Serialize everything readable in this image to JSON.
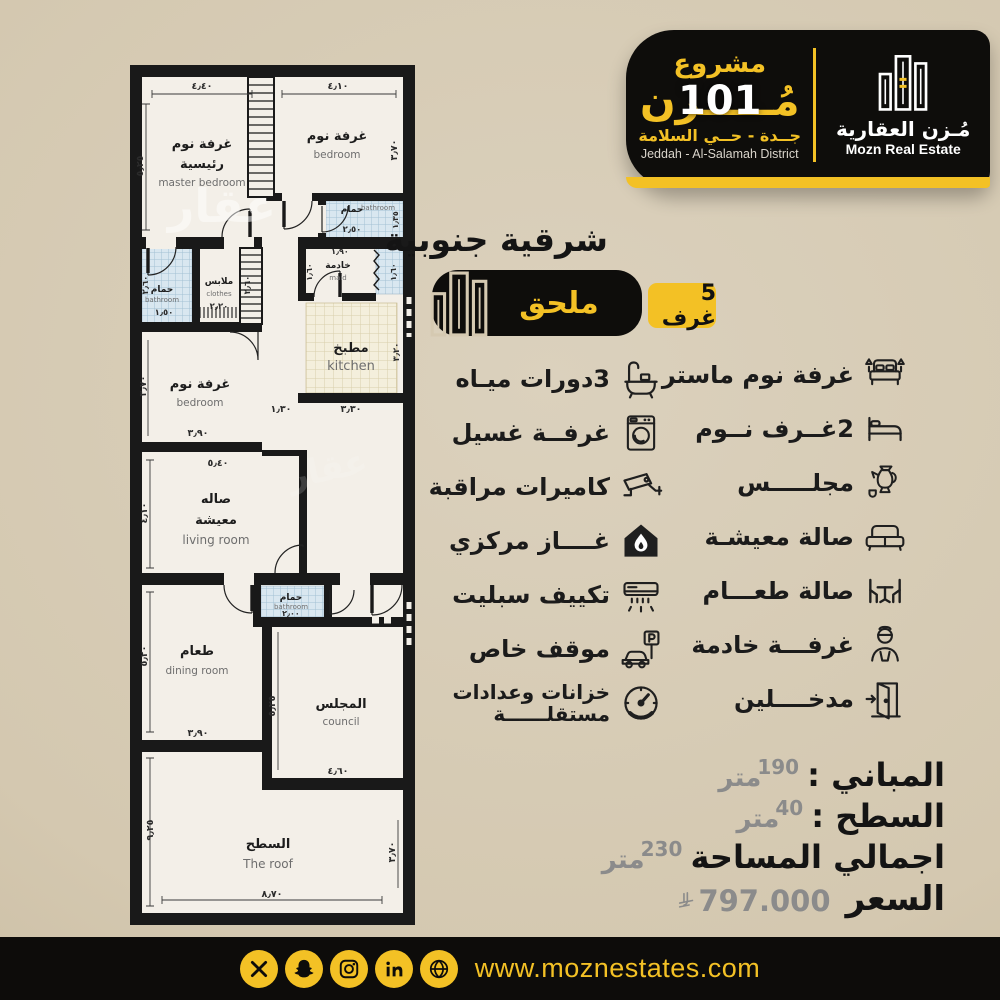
{
  "header": {
    "project_label": "مشروع",
    "project_name_ar": "مُـــــزن",
    "project_number": "101",
    "location_ar": "جــدة - حــي السلامة",
    "location_en": "Jeddah - Al-Salamah District",
    "brand_ar": "مُـزن العقارية",
    "brand_en": "Mozn Real Estate"
  },
  "orientation": "شرقية جنوبية",
  "badges": {
    "annex": "ملحق",
    "rooms_count": "5 غرف"
  },
  "features_left": [
    {
      "label": "3دورات ميـاه",
      "icon": "bathtub"
    },
    {
      "label": "غرفــة غسيل",
      "icon": "washing-machine"
    },
    {
      "label": "كاميرات مراقبة",
      "icon": "cctv-camera"
    },
    {
      "label": "غــــاز مركزي",
      "icon": "central-gas"
    },
    {
      "label": "تكييف سبليت",
      "icon": "split-ac"
    },
    {
      "label": "موقف خاص",
      "icon": "private-parking"
    },
    {
      "label": "خزانات وعدادات",
      "label2": "مستقلــــــة",
      "icon": "meters-gauge"
    }
  ],
  "features_right": [
    {
      "label": "غرفة نوم ماستر",
      "icon": "master-bed"
    },
    {
      "label": "2غــرف نــوم",
      "icon": "bed"
    },
    {
      "label": "مجلـــــس",
      "icon": "coffee-pot"
    },
    {
      "label": "صالة معيشـة",
      "icon": "sofa"
    },
    {
      "label": "صالة طعـــام",
      "icon": "dining-table"
    },
    {
      "label": "غرفـــة خادمة",
      "icon": "maid"
    },
    {
      "label": "مدخــــلين",
      "icon": "door"
    }
  ],
  "stats": [
    {
      "label": "المباني :",
      "value": "190",
      "unit": "متر"
    },
    {
      "label": "السطح :",
      "value": "40",
      "unit": "متر"
    },
    {
      "label": "اجمالي المساحة",
      "value": "230",
      "unit": "متر"
    }
  ],
  "price": {
    "label": "السعر",
    "value": "797.000",
    "currency": "SAR"
  },
  "footer": {
    "url": "www.moznestates.com",
    "icons": [
      "x",
      "snapchat",
      "instagram",
      "linkedin",
      "globe"
    ]
  },
  "plan": {
    "watermark": "عقار",
    "rooms": [
      {
        "ar": "غرفة نوم",
        "ar2": "رئيسية",
        "en": "master bedroom"
      },
      {
        "ar": "غرفة نوم",
        "en": "bedroom"
      },
      {
        "ar": "حمام",
        "en": "bathroom"
      },
      {
        "ar": "حمام",
        "en": "bathroom"
      },
      {
        "ar": "ملابس",
        "en": "clothes"
      },
      {
        "ar": "خادمة",
        "en": "maid"
      },
      {
        "ar": "مطبخ",
        "en": "kitchen"
      },
      {
        "ar": "غرفة نوم",
        "en": "bedroom"
      },
      {
        "ar": "صاله",
        "ar2": "معيشة",
        "en": "living room"
      },
      {
        "ar": "حمام",
        "en": "bathroom"
      },
      {
        "ar": "طعام",
        "en": "dining room"
      },
      {
        "ar": "المجلس",
        "en": "council"
      },
      {
        "ar": "السطح",
        "en": "The roof"
      }
    ],
    "dims": [
      "٤٫٤٠",
      "٥٫٢٥",
      "٤٫١٠",
      "٣٫٧٠",
      "٢٫٥٠",
      "١٫٣٥",
      "١٫٥٠",
      "٢٫٦٠",
      "٢٫٢٠",
      "٢٫٦٠",
      "١٫٩٠",
      "١٫٦٠",
      "١٫٦٠",
      "٣٫٣٠",
      "٣٫٢٠",
      "١٫٣٠",
      "٣٫٩٠",
      "٣٫٧٠",
      "٥٫٤٠",
      "٤٫١٠",
      "٢٫٠٠",
      "٥٫٢٠",
      "٣٫٩٠",
      "٥٫٢٥",
      "٤٫٦٠",
      "٩٫٢٥",
      "٨٫٧٠",
      "٣٫٧٠"
    ]
  },
  "colors": {
    "gold": "#F3C125",
    "black": "#0E0D0B",
    "beige": "#D5C9B1",
    "paper": "#F3EFE8",
    "bath_fill": "#D9E7F0",
    "kitchen_fill": "#F4EFDC"
  }
}
